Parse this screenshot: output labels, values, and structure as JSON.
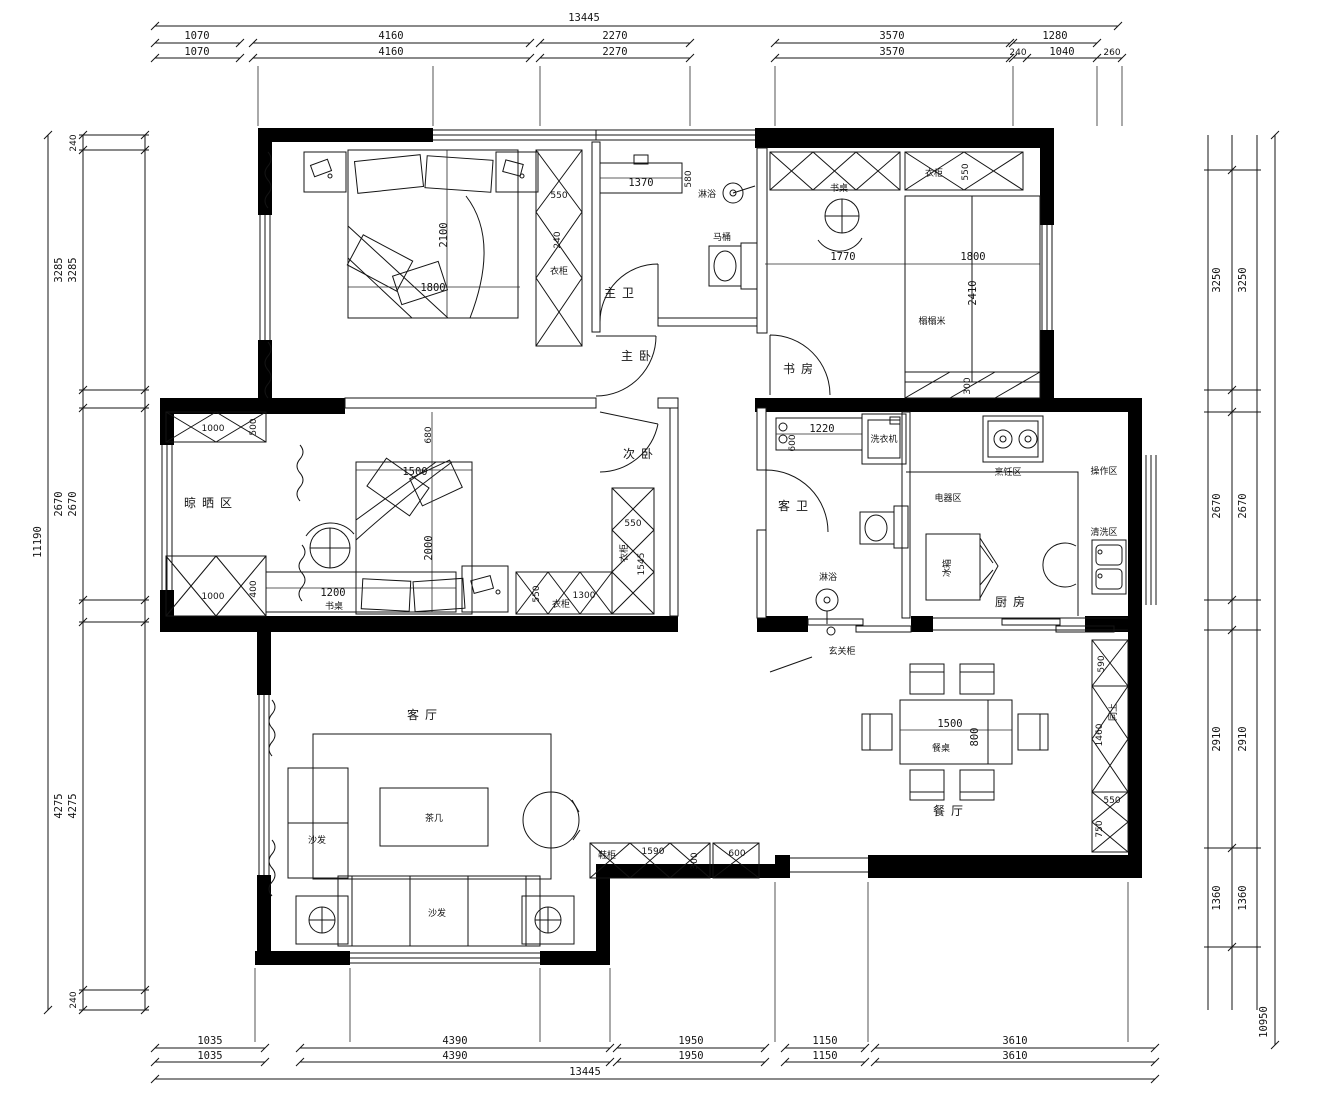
{
  "dims": {
    "top": {
      "overall": "13445",
      "r1": [
        "1070",
        "4160",
        "2270",
        "3570",
        "1280"
      ],
      "r2": [
        "1070",
        "4160",
        "2270",
        "3570",
        "240",
        "1040",
        "260"
      ]
    },
    "bottom": {
      "overall": "13445",
      "r1": [
        "1035",
        "4390",
        "1950",
        "1150",
        "3610"
      ],
      "r2": [
        "1035",
        "4390",
        "1950",
        "1150",
        "3610"
      ]
    },
    "left": {
      "overall": "11190",
      "outer": [
        "3285",
        "2670",
        "4275"
      ],
      "inner": [
        "240",
        "3285",
        "2670",
        "4275",
        "240"
      ]
    },
    "right": {
      "overall": "10950",
      "inner": [
        "3250",
        "2670",
        "2910",
        "1360"
      ],
      "outer": [
        "3250",
        "2670",
        "2910",
        "1360"
      ]
    }
  },
  "rooms": {
    "master_bedroom": "主卧",
    "master_bath": "主卫",
    "study": "书房",
    "second_bedroom": "次卧",
    "drying_area": "晾晒区",
    "guest_bath": "客卫",
    "kitchen": "厨房",
    "living_room": "客厅",
    "dining_room": "餐厅"
  },
  "kitchen_zones": {
    "cooking": "烹饪区",
    "appliance": "电器区",
    "prep": "操作区",
    "washing": "清洗区"
  },
  "furniture": {
    "wardrobe": "衣柜",
    "desk": "书桌",
    "tatami": "榻榻米",
    "coffee_table": "茶几",
    "sofa": "沙发",
    "dining_table": "餐桌",
    "dining_label": "餐厅",
    "entry_cabinet": "玄关柜",
    "shoe_cabinet": "鞋柜",
    "washing_machine": "洗衣机",
    "toilet": "马桶",
    "shower": "淋浴",
    "fridge": "冰箱",
    "same_as_above": "同上"
  },
  "ann": {
    "bed1_len": "2100",
    "bed1_w": "1800",
    "wr1_w": "550",
    "wr1_d": "240",
    "vanity": "1370",
    "vanity_d": "580",
    "study_w": "1770",
    "tatami_w": "1800",
    "tatami_l": "2410",
    "wr2_w": "550",
    "shelf_d": "300",
    "gap": "680",
    "bed2_w": "1500",
    "bed2_len": "2000",
    "desk2_w": "1200",
    "cab_top_w": "1000",
    "cab_top_d": "500",
    "cab_bot_w": "1000",
    "cab_bot_d": "400",
    "wr3_w": "550",
    "wr3_len": "1545",
    "wr4_d": "550",
    "wr4_w": "1300",
    "bath2_cab": "1220",
    "bath2_cab_d": "600",
    "table_l": "1500",
    "table_w": "800",
    "shoe1_w": "1590",
    "shoe1_d": "300",
    "shoe2_w": "600",
    "ent1": "590",
    "ent2": "1460",
    "ent3": "550",
    "ent4": "750"
  }
}
